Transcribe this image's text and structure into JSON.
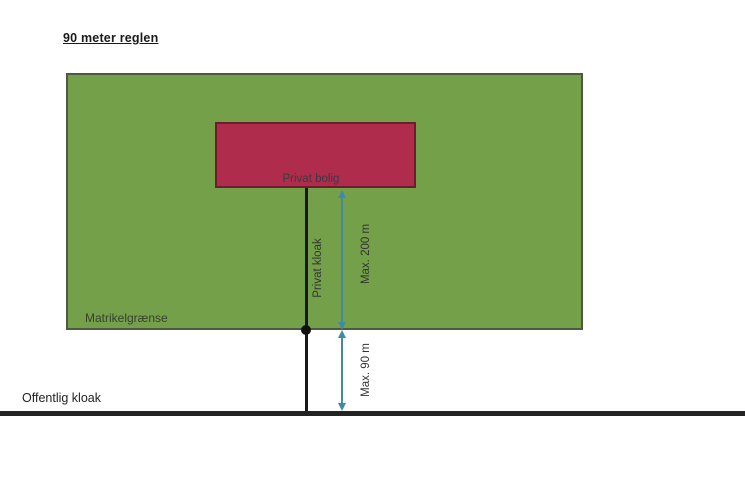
{
  "title": "90 meter reglen",
  "diagram": {
    "house_label": "Privat bolig",
    "private_sewer_label": "Privat kloak",
    "distance_house_to_boundary": "Max. 200 m",
    "distance_boundary_to_public_sewer": "Max. 90 m",
    "parcel_boundary_label": "Matrikelgrænse",
    "public_sewer_label": "Offentlig kloak"
  },
  "colors": {
    "parcel_green": "#74a04a",
    "house_red": "#b02c4c",
    "arrow_teal": "#3f8ba3",
    "line_black": "#1f1f1f"
  }
}
